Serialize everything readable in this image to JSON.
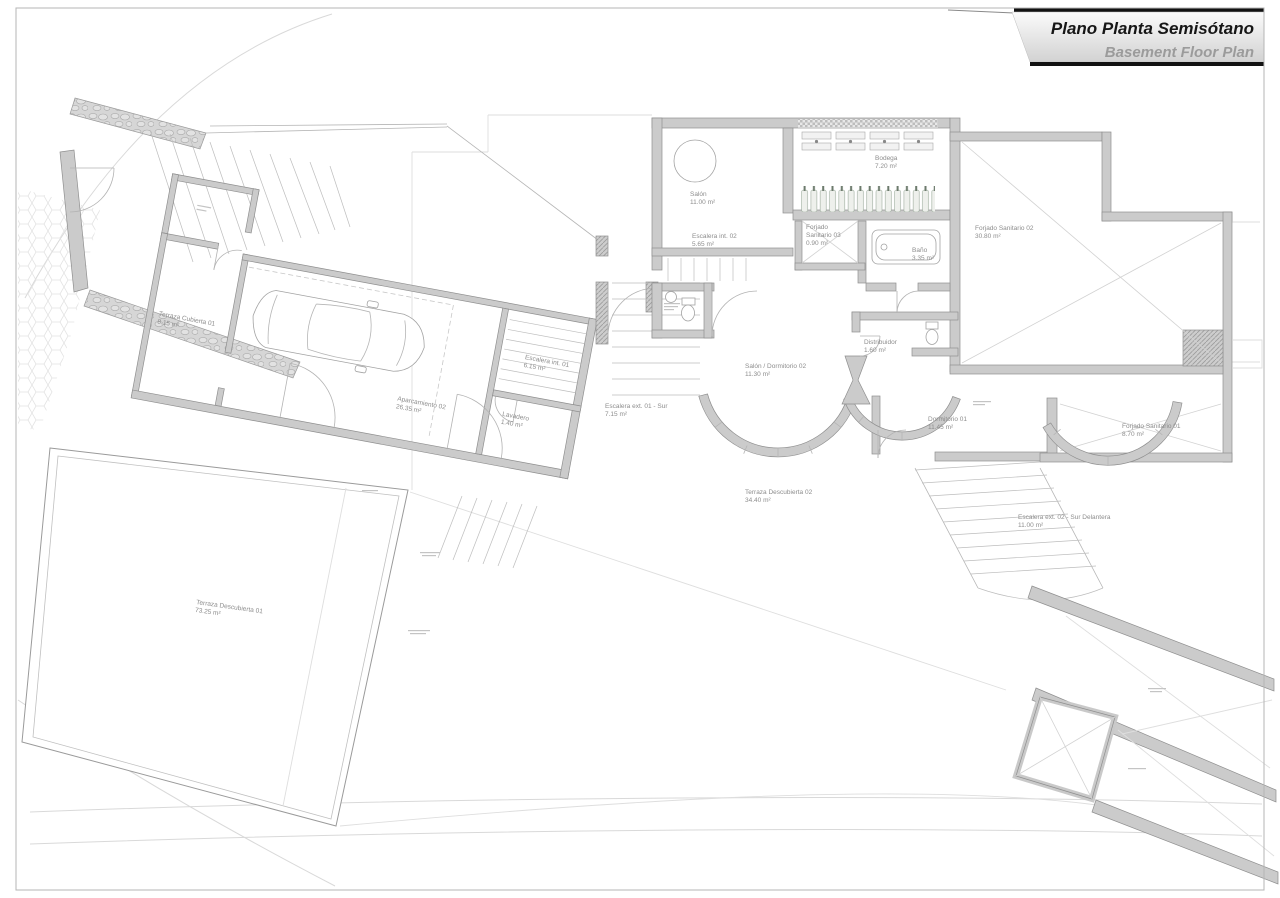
{
  "title": {
    "es": "Plano Planta Semisótano",
    "en": "Basement Floor Plan"
  },
  "rooms": {
    "terraza_cubierta_01": {
      "label": "Terraza Cubierta 01",
      "area": "8.15 m²"
    },
    "aparcamiento_02": {
      "label": "Aparcamiento 02",
      "area": "26.35 m²"
    },
    "lavadero": {
      "label": "Lavadero",
      "area": "1.40 m²"
    },
    "escalera_int_01": {
      "label": "Escalera int. 01",
      "area": "6.15 m²"
    },
    "escalera_ext_01": {
      "label": "Escalera ext. 01 - Sur",
      "area": "7.15 m²"
    },
    "salon": {
      "label": "Salón",
      "area": "11.00 m²"
    },
    "escalera_int_02": {
      "label": "Escalera int. 02",
      "area": "5.65 m²"
    },
    "bodega": {
      "label": "Bodega",
      "area": "7.20 m²"
    },
    "forjado_sanitario_03": {
      "label": "Forjado",
      "label2": "Sanitario 03",
      "area": "0.90 m²"
    },
    "bano": {
      "label": "Baño",
      "area": "3.35 m²"
    },
    "forjado_sanitario_02": {
      "label": "Forjado Sanitario 02",
      "area": "30.80 m²"
    },
    "salon_dormitorio_02": {
      "label": "Salón / Dormitorio 02",
      "area": "11.30 m²"
    },
    "distribuidor": {
      "label": "Distribuidor",
      "area": "1.60 m²"
    },
    "dormitorio_01": {
      "label": "Dormitorio 01",
      "area": "11.45 m²"
    },
    "forjado_sanitario_01": {
      "label": "Forjado Sanitario 01",
      "area": "8.70 m²"
    },
    "terraza_descubierta_02": {
      "label": "Terraza Descubierta 02",
      "area": "34.40 m²"
    },
    "escalera_ext_02": {
      "label": "Escalera ext. 02 - Sur Delantera",
      "area": "11.00 m²"
    },
    "terraza_descubierta_01": {
      "label": "Terraza Descubierta 01",
      "area": "73.25 m²"
    }
  },
  "colors": {
    "wall": "#cbcbcb",
    "wall_stroke": "#8f8f8f",
    "label": "#8d8d8d",
    "title": "#161616",
    "subtitle": "#9b9b9b"
  }
}
